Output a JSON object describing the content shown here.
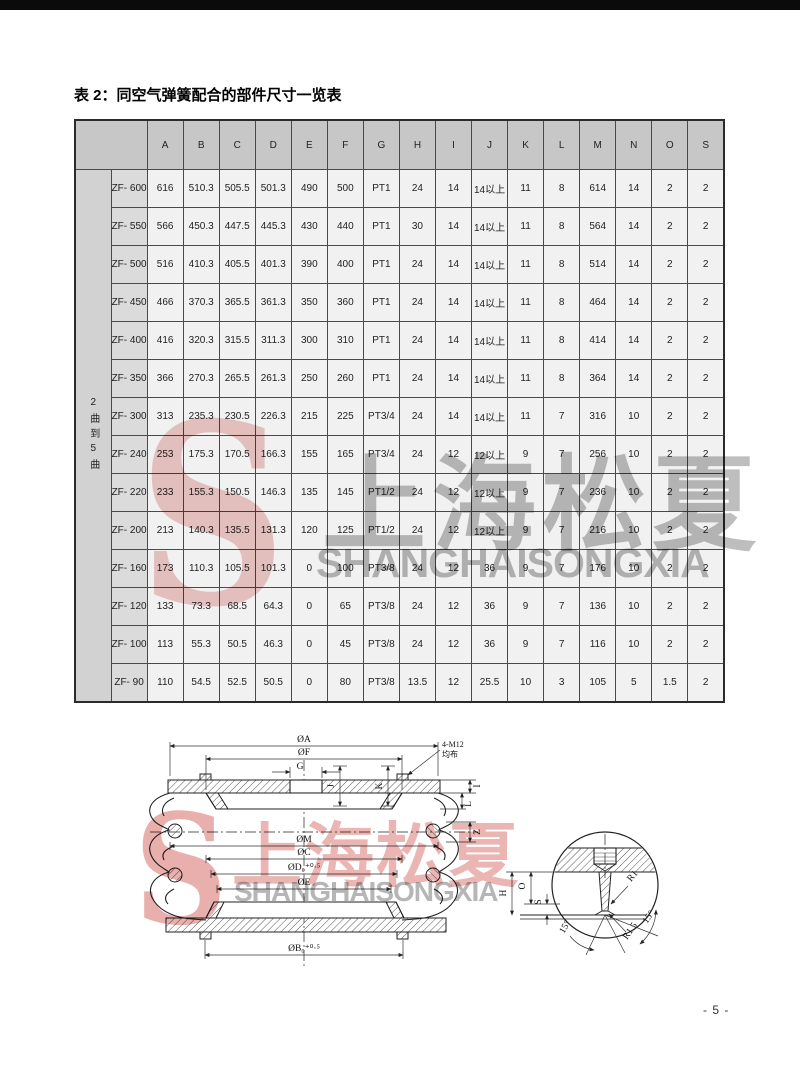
{
  "page": {
    "title": "表 2：同空气弹簧配合的部件尺寸一览表",
    "page_number": "- 5 -"
  },
  "table": {
    "row_group_label": "2曲到5曲",
    "columns": [
      "A",
      "B",
      "C",
      "D",
      "E",
      "F",
      "G",
      "H",
      "I",
      "J",
      "K",
      "L",
      "M",
      "N",
      "O",
      "S"
    ],
    "rows": [
      {
        "model": "ZF- 600",
        "values": [
          "616",
          "510.3",
          "505.5",
          "501.3",
          "490",
          "500",
          "PT1",
          "24",
          "14",
          "14以上",
          "11",
          "8",
          "614",
          "14",
          "2",
          "2"
        ]
      },
      {
        "model": "ZF- 550",
        "values": [
          "566",
          "450.3",
          "447.5",
          "445.3",
          "430",
          "440",
          "PT1",
          "30",
          "14",
          "14以上",
          "11",
          "8",
          "564",
          "14",
          "2",
          "2"
        ]
      },
      {
        "model": "ZF- 500",
        "values": [
          "516",
          "410.3",
          "405.5",
          "401.3",
          "390",
          "400",
          "PT1",
          "24",
          "14",
          "14以上",
          "11",
          "8",
          "514",
          "14",
          "2",
          "2"
        ]
      },
      {
        "model": "ZF- 450",
        "values": [
          "466",
          "370.3",
          "365.5",
          "361.3",
          "350",
          "360",
          "PT1",
          "24",
          "14",
          "14以上",
          "11",
          "8",
          "464",
          "14",
          "2",
          "2"
        ]
      },
      {
        "model": "ZF- 400",
        "values": [
          "416",
          "320.3",
          "315.5",
          "311.3",
          "300",
          "310",
          "PT1",
          "24",
          "14",
          "14以上",
          "11",
          "8",
          "414",
          "14",
          "2",
          "2"
        ]
      },
      {
        "model": "ZF- 350",
        "values": [
          "366",
          "270.3",
          "265.5",
          "261.3",
          "250",
          "260",
          "PT1",
          "24",
          "14",
          "14以上",
          "11",
          "8",
          "364",
          "14",
          "2",
          "2"
        ]
      },
      {
        "model": "ZF- 300",
        "values": [
          "313",
          "235.3",
          "230.5",
          "226.3",
          "215",
          "225",
          "PT3/4",
          "24",
          "14",
          "14以上",
          "11",
          "7",
          "316",
          "10",
          "2",
          "2"
        ]
      },
      {
        "model": "ZF- 240",
        "values": [
          "253",
          "175.3",
          "170.5",
          "166.3",
          "155",
          "165",
          "PT3/4",
          "24",
          "12",
          "12以上",
          "9",
          "7",
          "256",
          "10",
          "2",
          "2"
        ]
      },
      {
        "model": "ZF- 220",
        "values": [
          "233",
          "155.3",
          "150.5",
          "146.3",
          "135",
          "145",
          "PT1/2",
          "24",
          "12",
          "12以上",
          "9",
          "7",
          "236",
          "10",
          "2",
          "2"
        ]
      },
      {
        "model": "ZF- 200",
        "values": [
          "213",
          "140.3",
          "135.5",
          "131.3",
          "120",
          "125",
          "PT1/2",
          "24",
          "12",
          "12以上",
          "9",
          "7",
          "216",
          "10",
          "2",
          "2"
        ]
      },
      {
        "model": "ZF- 160",
        "values": [
          "173",
          "110.3",
          "105.5",
          "101.3",
          "0",
          "100",
          "PT3/8",
          "24",
          "12",
          "36",
          "9",
          "7",
          "176",
          "10",
          "2",
          "2"
        ]
      },
      {
        "model": "ZF- 120",
        "values": [
          "133",
          "73.3",
          "68.5",
          "64.3",
          "0",
          "65",
          "PT3/8",
          "24",
          "12",
          "36",
          "9",
          "7",
          "136",
          "10",
          "2",
          "2"
        ]
      },
      {
        "model": "ZF- 100",
        "values": [
          "113",
          "55.3",
          "50.5",
          "46.3",
          "0",
          "45",
          "PT3/8",
          "24",
          "12",
          "36",
          "9",
          "7",
          "116",
          "10",
          "2",
          "2"
        ]
      },
      {
        "model": "ZF- 90",
        "values": [
          "110",
          "54.5",
          "52.5",
          "50.5",
          "0",
          "80",
          "PT3/8",
          "13.5",
          "12",
          "25.5",
          "10",
          "3",
          "105",
          "5",
          "1.5",
          "2"
        ]
      }
    ]
  },
  "watermark": {
    "logo": "S",
    "cn": "上海松夏",
    "en": "SHANGHAISONGXIA",
    "red": "#cd4e48",
    "grey": "#8a8a8a"
  },
  "diagram": {
    "left": {
      "a": "ØA",
      "f": "ØF",
      "g": "G",
      "bolt1": "4-M12",
      "bolt2": "均布",
      "j": "J",
      "k": "K",
      "i": "I",
      "l": "L",
      "z": "Z",
      "m": "ØM",
      "c": "ØC",
      "d": "ØD₀⁺⁰·⁵",
      "e": "ØE",
      "b": "ØB₀⁺⁰·⁵"
    },
    "detail": {
      "h": "H",
      "o": "O",
      "s": "S",
      "r1": "R1",
      "r15": "R1.5",
      "ang1": "15°",
      "ang2": "15°"
    }
  }
}
